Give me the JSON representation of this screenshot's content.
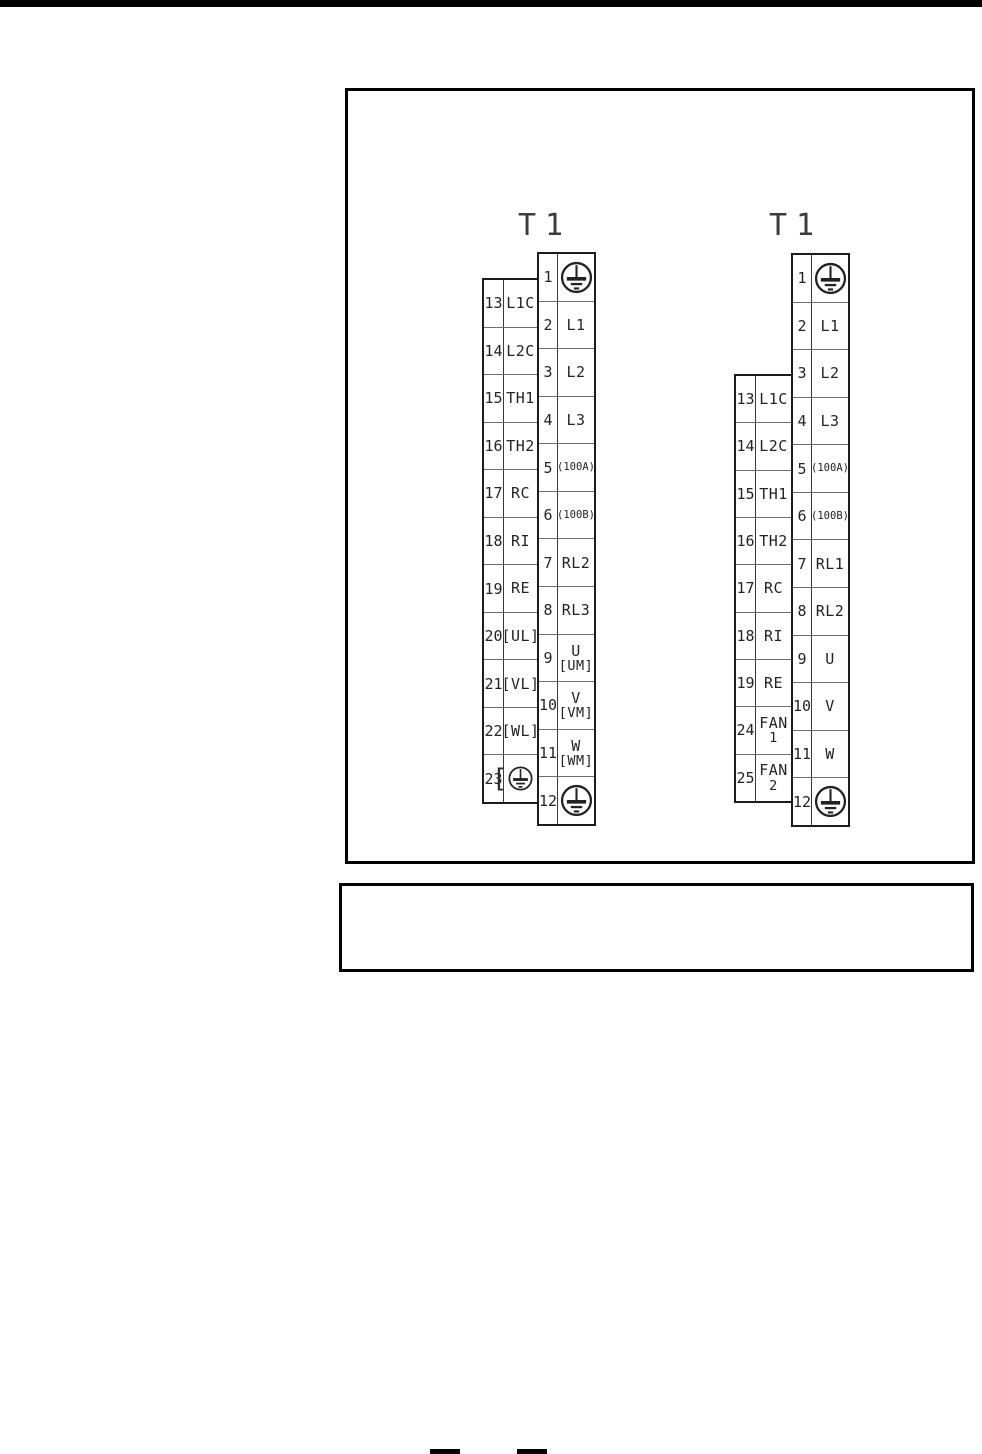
{
  "page": {
    "top_bar_color": "#000000",
    "background_color": "#ffffff",
    "line_color": "#1c1c1c"
  },
  "diagrams": [
    {
      "title": "T1",
      "main_rows": [
        {
          "num": "1",
          "icon": "ground-icon"
        },
        {
          "num": "2",
          "label": "L1"
        },
        {
          "num": "3",
          "label": "L2"
        },
        {
          "num": "4",
          "label": "L3"
        },
        {
          "num": "5",
          "label": "(100A)"
        },
        {
          "num": "6",
          "label": "(100B)"
        },
        {
          "num": "7",
          "label": "RL2"
        },
        {
          "num": "8",
          "label": "RL3"
        },
        {
          "num": "9",
          "label": "U",
          "label2": "[UM]"
        },
        {
          "num": "10",
          "label": "V",
          "label2": "[VM]"
        },
        {
          "num": "11",
          "label": "W",
          "label2": "[WM]"
        },
        {
          "num": "12",
          "icon": "ground-icon"
        }
      ],
      "side_rows": [
        {
          "num": "13",
          "label": "L1C"
        },
        {
          "num": "14",
          "label": "L2C"
        },
        {
          "num": "15",
          "label": "TH1"
        },
        {
          "num": "16",
          "label": "TH2"
        },
        {
          "num": "17",
          "label": "RC"
        },
        {
          "num": "18",
          "label": "RI"
        },
        {
          "num": "19",
          "label": "RE"
        },
        {
          "num": "20",
          "label": "[UL]"
        },
        {
          "num": "21",
          "label": "[VL]"
        },
        {
          "num": "22",
          "label": "[WL]"
        },
        {
          "num": "23",
          "icon": "ground-bracketed-icon"
        }
      ]
    },
    {
      "title": "T1",
      "main_rows": [
        {
          "num": "1",
          "icon": "ground-icon"
        },
        {
          "num": "2",
          "label": "L1"
        },
        {
          "num": "3",
          "label": "L2"
        },
        {
          "num": "4",
          "label": "L3"
        },
        {
          "num": "5",
          "label": "(100A)"
        },
        {
          "num": "6",
          "label": "(100B)"
        },
        {
          "num": "7",
          "label": "RL1"
        },
        {
          "num": "8",
          "label": "RL2"
        },
        {
          "num": "9",
          "label": "U"
        },
        {
          "num": "10",
          "label": "V"
        },
        {
          "num": "11",
          "label": "W"
        },
        {
          "num": "12",
          "icon": "ground-icon"
        }
      ],
      "side_rows": [
        {
          "num": "13",
          "label": "L1C"
        },
        {
          "num": "14",
          "label": "L2C"
        },
        {
          "num": "15",
          "label": "TH1"
        },
        {
          "num": "16",
          "label": "TH2"
        },
        {
          "num": "17",
          "label": "RC"
        },
        {
          "num": "18",
          "label": "RI"
        },
        {
          "num": "19",
          "label": "RE"
        },
        {
          "num": "24",
          "label": "FAN",
          "label2": "1"
        },
        {
          "num": "25",
          "label": "FAN",
          "label2": "2"
        }
      ]
    }
  ]
}
